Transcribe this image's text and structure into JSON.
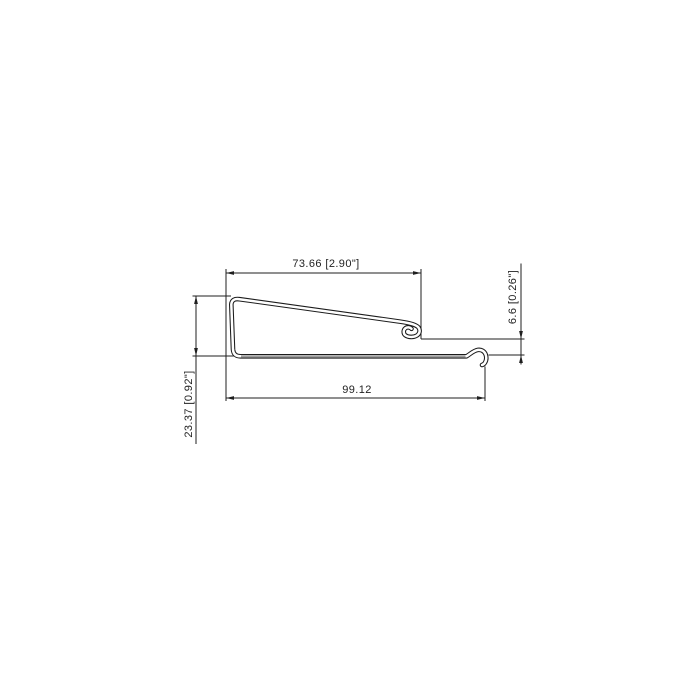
{
  "drawing": {
    "title": "profile-cross-section",
    "dimensions": {
      "top": {
        "label": "73.66 [2.90\"]"
      },
      "bottom": {
        "label": "99.12"
      },
      "right": {
        "label": "6.6 [0.26\"]"
      },
      "left": {
        "label": "23.37 [0.92\"]"
      }
    },
    "colors": {
      "background": "#ffffff",
      "line": "#1f1f1f",
      "sheet_shade": "#9e9e9e"
    }
  }
}
